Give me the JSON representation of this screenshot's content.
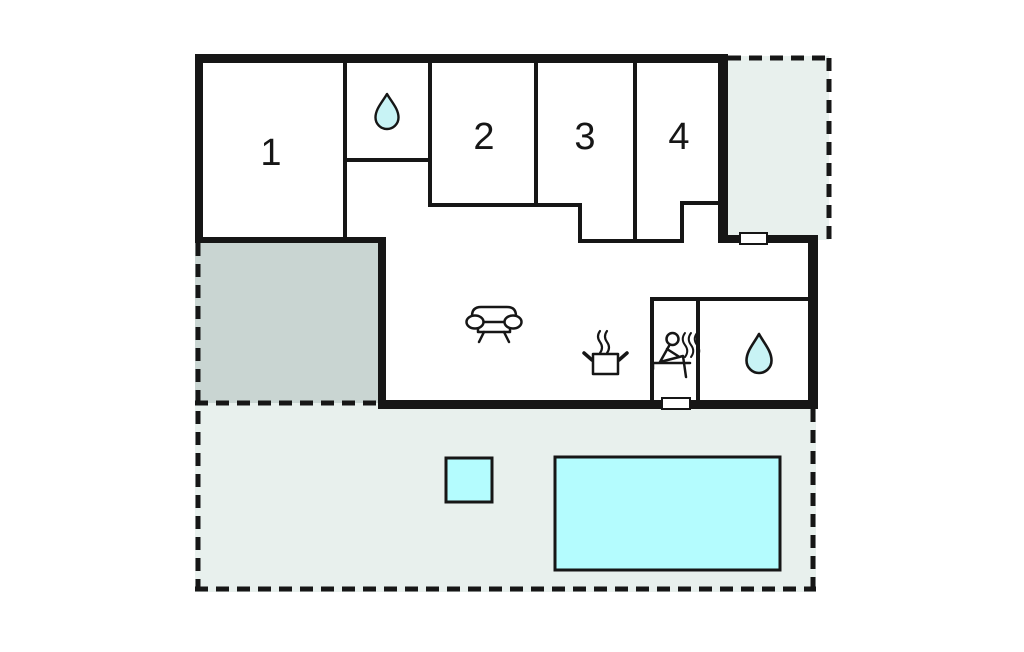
{
  "plan": {
    "type": "holiday-home-floor-plan",
    "rooms": {
      "room1": {
        "label": "1"
      },
      "room2": {
        "label": "2"
      },
      "room3": {
        "label": "3"
      },
      "room4": {
        "label": "4"
      }
    },
    "icons": {
      "bathroom_top": "water-drop-icon",
      "bathroom_back": "water-drop-icon",
      "living_room": "sofa-icon",
      "kitchen": "cooking-pot-icon",
      "sauna": "sauna-person-icon"
    },
    "features": {
      "doors": 2,
      "outdoor_areas": [
        "side-terrace",
        "carport",
        "garden-terrace"
      ],
      "water_features": [
        "hot-tub",
        "swimming-pool"
      ]
    }
  },
  "colors": {
    "wall": "#161616",
    "terrace": "#e8f0ed",
    "carport": "#c9d5d2",
    "water": "#b4fcfe",
    "drop": "#c8f3f5",
    "floor": "#ffffff"
  }
}
